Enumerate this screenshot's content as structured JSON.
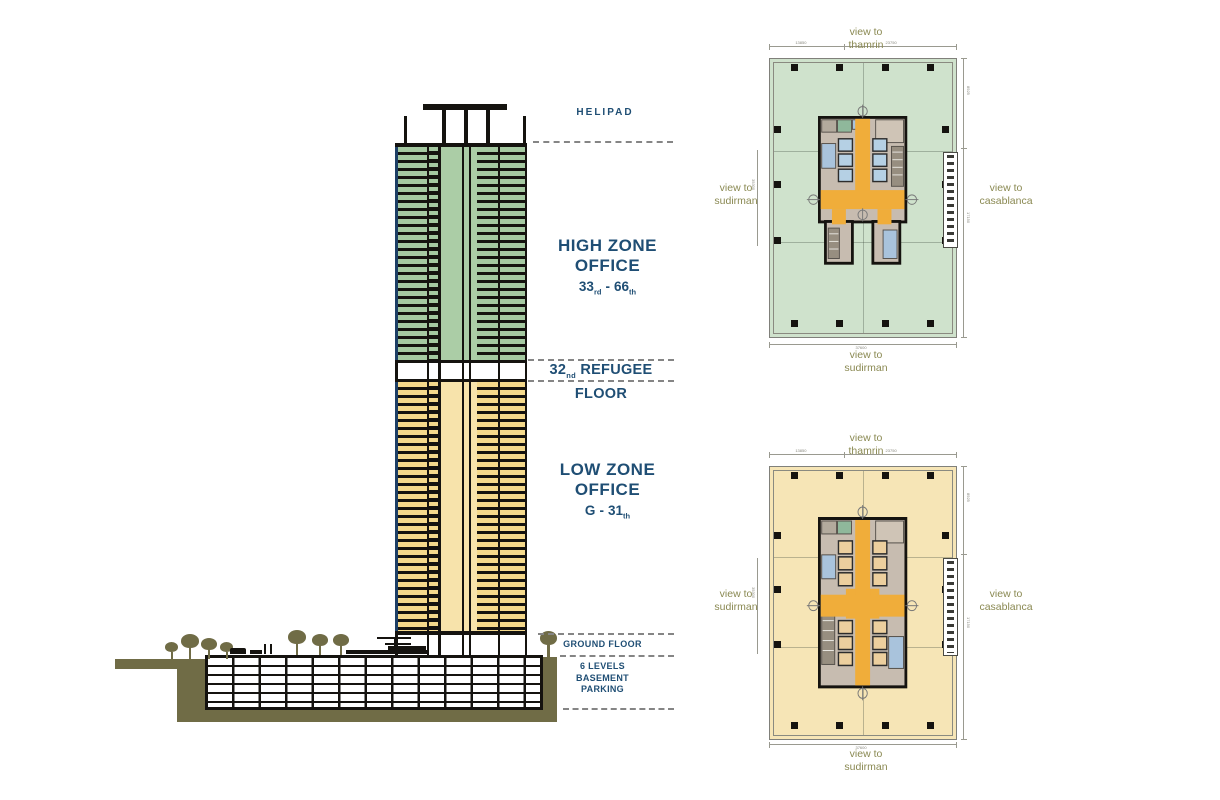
{
  "section": {
    "helipad_label": "HELIPAD",
    "high_zone": {
      "line1": "HIGH ZONE",
      "line2": "OFFICE",
      "from": "33",
      "from_ord": "rd",
      "dash": "-",
      "to": "66",
      "to_ord": "th"
    },
    "refugee": {
      "num": "32",
      "ord": "nd",
      "label": "REFUGEE FLOOR"
    },
    "low_zone": {
      "line1": "LOW ZONE",
      "line2": "OFFICE",
      "from": "G",
      "dash": "-",
      "to": "31",
      "to_ord": "th"
    },
    "ground_label": "GROUND FLOOR",
    "basement": {
      "line1": "6 LEVELS",
      "line2": "BASEMENT",
      "line3": "PARKING"
    },
    "colors": {
      "high_zone_green": "#a5c9a1",
      "low_zone_yellow": "#f5d98b",
      "core_orange": "#f0ad3a",
      "label_blue": "#1f4e74",
      "ground_olive": "#706c46",
      "structure_black": "#15130f"
    }
  },
  "plans": [
    {
      "name": "high zone typical floor plan",
      "bg": "#cfe2cc",
      "views": {
        "top": {
          "prefix": "view to",
          "name": "thamrin"
        },
        "left": {
          "prefix": "view to",
          "name": "sudirman"
        },
        "right": {
          "prefix": "view to",
          "name": "casablanca"
        },
        "bottom": {
          "prefix": "view to",
          "name": "sudirman"
        }
      },
      "dims": {
        "top1": "13850",
        "top2": "23750",
        "bottom": "37600",
        "right1": "8925",
        "right2": "17150",
        "left": "35300"
      }
    },
    {
      "name": "low zone typical floor plan",
      "bg": "#f6e5b6",
      "views": {
        "top": {
          "prefix": "view to",
          "name": "thamrin"
        },
        "left": {
          "prefix": "view to",
          "name": "sudirman"
        },
        "right": {
          "prefix": "view to",
          "name": "casablanca"
        },
        "bottom": {
          "prefix": "view to",
          "name": "sudirman"
        }
      },
      "dims": {
        "top1": "13850",
        "top2": "23750",
        "bottom": "37600",
        "right1": "8925",
        "right2": "17150",
        "left": "35300"
      }
    }
  ]
}
